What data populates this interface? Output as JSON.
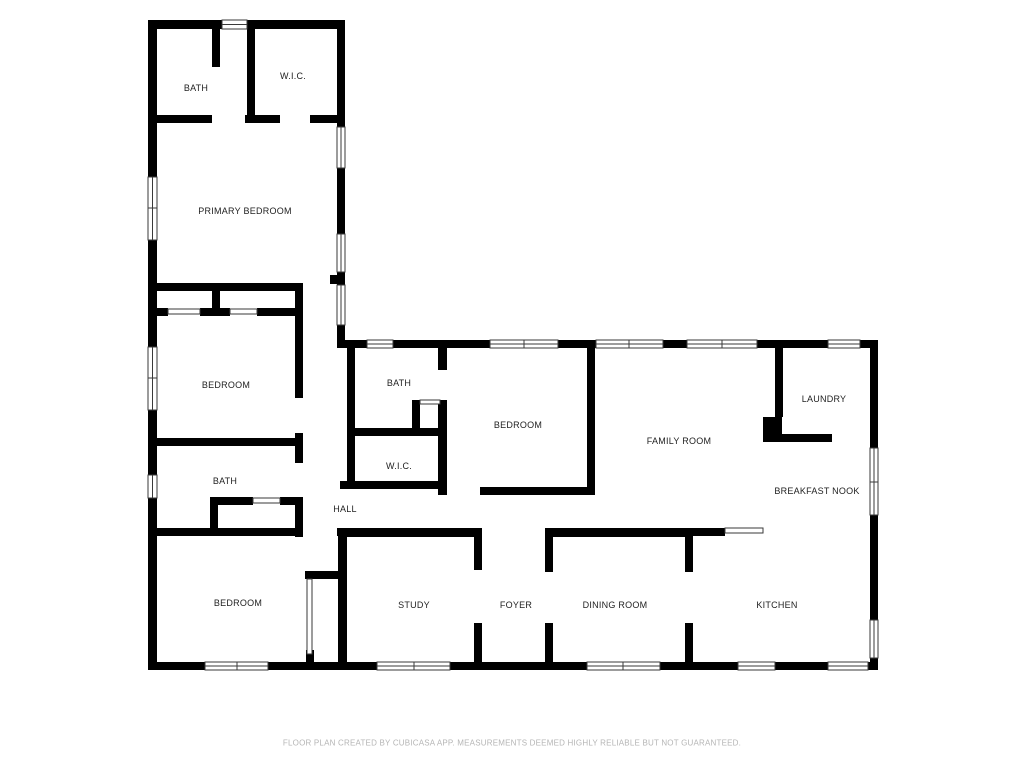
{
  "colors": {
    "wall": "#000000",
    "background": "#ffffff",
    "label_text": "#222222",
    "footer_text": "#b5b5b5"
  },
  "floor_plan": {
    "rooms": [
      {
        "id": "bath-upper",
        "label": "BATH"
      },
      {
        "id": "wic-upper",
        "label": "W.I.C."
      },
      {
        "id": "primary-bedroom",
        "label": "PRIMARY BEDROOM"
      },
      {
        "id": "bedroom-left",
        "label": "BEDROOM"
      },
      {
        "id": "bath-middle",
        "label": "BATH"
      },
      {
        "id": "bedroom-middle",
        "label": "BEDROOM"
      },
      {
        "id": "family-room",
        "label": "FAMILY ROOM"
      },
      {
        "id": "laundry",
        "label": "LAUNDRY"
      },
      {
        "id": "breakfast-nook",
        "label": "BREAKFAST NOOK"
      },
      {
        "id": "bath-lower",
        "label": "BATH"
      },
      {
        "id": "wic-middle",
        "label": "W.I.C."
      },
      {
        "id": "hall",
        "label": "HALL"
      },
      {
        "id": "bedroom-lower",
        "label": "BEDROOM"
      },
      {
        "id": "study",
        "label": "STUDY"
      },
      {
        "id": "foyer",
        "label": "FOYER"
      },
      {
        "id": "dining-room",
        "label": "DINING ROOM"
      },
      {
        "id": "kitchen",
        "label": "KITCHEN"
      }
    ]
  },
  "footer": {
    "disclaimer": "FLOOR PLAN CREATED BY CUBICASA APP. MEASUREMENTS DEEMED HIGHLY RELIABLE BUT NOT GUARANTEED."
  }
}
